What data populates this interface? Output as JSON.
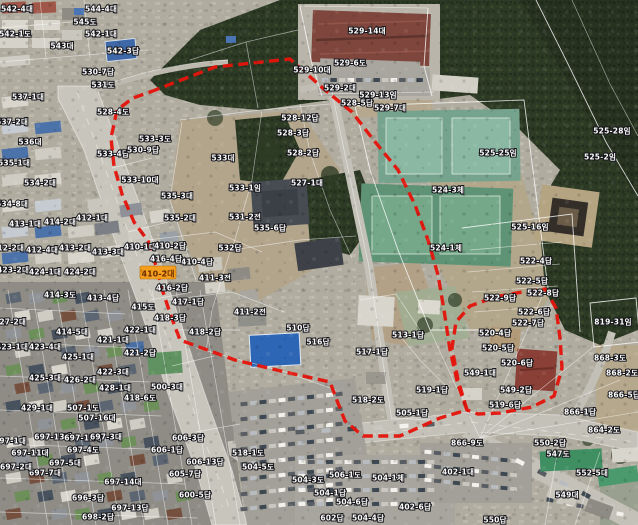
{
  "map": {
    "colors": {
      "selection_boundary": "#e4150c",
      "selected_highlight": "#f59f1e",
      "parcel_label": "#ffffff",
      "cadastral_line": "#ffffff"
    },
    "selected_parcel": {
      "text": "410-2대",
      "x": 158,
      "y": 273
    },
    "selection_boundary": {
      "main": [
        [
          150,
          92
        ],
        [
          215,
          67
        ],
        [
          290,
          59
        ],
        [
          325,
          90
        ],
        [
          352,
          112
        ],
        [
          372,
          138
        ],
        [
          398,
          170
        ],
        [
          415,
          205
        ],
        [
          428,
          240
        ],
        [
          438,
          275
        ],
        [
          444,
          310
        ],
        [
          450,
          350
        ],
        [
          458,
          385
        ],
        [
          467,
          410
        ],
        [
          440,
          418
        ],
        [
          400,
          436
        ],
        [
          363,
          436
        ],
        [
          345,
          421
        ],
        [
          336,
          398
        ],
        [
          330,
          382
        ],
        [
          285,
          372
        ],
        [
          235,
          360
        ],
        [
          180,
          340
        ],
        [
          171,
          316
        ],
        [
          163,
          292
        ],
        [
          156,
          266
        ],
        [
          148,
          241
        ],
        [
          134,
          222
        ],
        [
          122,
          194
        ],
        [
          114,
          166
        ],
        [
          111,
          138
        ],
        [
          117,
          110
        ],
        [
          133,
          98
        ]
      ],
      "east_loop": [
        [
          467,
          410
        ],
        [
          458,
          380
        ],
        [
          452,
          348
        ],
        [
          456,
          322
        ],
        [
          470,
          306
        ],
        [
          495,
          297
        ],
        [
          522,
          292
        ],
        [
          545,
          289
        ],
        [
          556,
          308
        ],
        [
          560,
          338
        ],
        [
          562,
          368
        ],
        [
          554,
          396
        ],
        [
          532,
          407
        ],
        [
          500,
          413
        ],
        [
          478,
          414
        ]
      ]
    },
    "parcel_labels": [
      {
        "t": "542-4대",
        "x": 17,
        "y": 9
      },
      {
        "t": "544-4대",
        "x": 101,
        "y": 9
      },
      {
        "t": "545도",
        "x": 85,
        "y": 22
      },
      {
        "t": "542-1도",
        "x": 15,
        "y": 34
      },
      {
        "t": "542-1대",
        "x": 101,
        "y": 34
      },
      {
        "t": "543대",
        "x": 62,
        "y": 46
      },
      {
        "t": "542-3답",
        "x": 123,
        "y": 51
      },
      {
        "t": "530-7답",
        "x": 98,
        "y": 72
      },
      {
        "t": "531도",
        "x": 103,
        "y": 85
      },
      {
        "t": "528-4도",
        "x": 113,
        "y": 112
      },
      {
        "t": "533-4답",
        "x": 113,
        "y": 154
      },
      {
        "t": "537-1대",
        "x": 28,
        "y": 97
      },
      {
        "t": "537-2대",
        "x": 12,
        "y": 122
      },
      {
        "t": "536대",
        "x": 30,
        "y": 142
      },
      {
        "t": "535-1대",
        "x": 14,
        "y": 163
      },
      {
        "t": "534-2대",
        "x": 40,
        "y": 183
      },
      {
        "t": "534-8대",
        "x": 12,
        "y": 204
      },
      {
        "t": "413-1대",
        "x": 25,
        "y": 224
      },
      {
        "t": "414-2대",
        "x": 60,
        "y": 222
      },
      {
        "t": "412-1대",
        "x": 92,
        "y": 218
      },
      {
        "t": "412-2대",
        "x": 8,
        "y": 248
      },
      {
        "t": "412-4대",
        "x": 42,
        "y": 250
      },
      {
        "t": "413-2대",
        "x": 75,
        "y": 248
      },
      {
        "t": "413-3대",
        "x": 108,
        "y": 252
      },
      {
        "t": "410-1대",
        "x": 140,
        "y": 247
      },
      {
        "t": "423-2대",
        "x": 13,
        "y": 270
      },
      {
        "t": "424-1대",
        "x": 45,
        "y": 272
      },
      {
        "t": "424-2대",
        "x": 80,
        "y": 272
      },
      {
        "t": "533-3도",
        "x": 155,
        "y": 139
      },
      {
        "t": "530-9답",
        "x": 143,
        "y": 150
      },
      {
        "t": "533-10대",
        "x": 140,
        "y": 180
      },
      {
        "t": "533대",
        "x": 223,
        "y": 158
      },
      {
        "t": "533-1임",
        "x": 245,
        "y": 188
      },
      {
        "t": "535-3대",
        "x": 177,
        "y": 196
      },
      {
        "t": "535-2대",
        "x": 180,
        "y": 218
      },
      {
        "t": "531-2전",
        "x": 245,
        "y": 217
      },
      {
        "t": "535-6답",
        "x": 270,
        "y": 228
      },
      {
        "t": "528-2답",
        "x": 303,
        "y": 153
      },
      {
        "t": "527-1대",
        "x": 307,
        "y": 183
      },
      {
        "t": "532답",
        "x": 230,
        "y": 248
      },
      {
        "t": "510답",
        "x": 298,
        "y": 328
      },
      {
        "t": "516답",
        "x": 318,
        "y": 342
      },
      {
        "t": "517-1답",
        "x": 372,
        "y": 352
      },
      {
        "t": "513-1답",
        "x": 408,
        "y": 335
      },
      {
        "t": "529-14대",
        "x": 367,
        "y": 31
      },
      {
        "t": "529-6도",
        "x": 350,
        "y": 63
      },
      {
        "t": "529-10대",
        "x": 312,
        "y": 70
      },
      {
        "t": "529-2대",
        "x": 340,
        "y": 88
      },
      {
        "t": "528-5답",
        "x": 357,
        "y": 103
      },
      {
        "t": "528-12답",
        "x": 300,
        "y": 118
      },
      {
        "t": "528-3답",
        "x": 293,
        "y": 133
      },
      {
        "t": "529-13임",
        "x": 378,
        "y": 95
      },
      {
        "t": "529-7대",
        "x": 390,
        "y": 108
      },
      {
        "t": "524-3체",
        "x": 448,
        "y": 190
      },
      {
        "t": "525-25임",
        "x": 498,
        "y": 153
      },
      {
        "t": "525-16임",
        "x": 530,
        "y": 227
      },
      {
        "t": "524-1체",
        "x": 446,
        "y": 248
      },
      {
        "t": "525-2임",
        "x": 600,
        "y": 157
      },
      {
        "t": "525-28임",
        "x": 612,
        "y": 131
      },
      {
        "t": "522-4답",
        "x": 536,
        "y": 261
      },
      {
        "t": "522-5답",
        "x": 532,
        "y": 281
      },
      {
        "t": "522-8답",
        "x": 543,
        "y": 293
      },
      {
        "t": "522-9답",
        "x": 500,
        "y": 298
      },
      {
        "t": "522-6답",
        "x": 534,
        "y": 312
      },
      {
        "t": "522-7답",
        "x": 528,
        "y": 323
      },
      {
        "t": "520-4답",
        "x": 495,
        "y": 333
      },
      {
        "t": "520-5답",
        "x": 498,
        "y": 348
      },
      {
        "t": "520-6답",
        "x": 517,
        "y": 363
      },
      {
        "t": "549-1대",
        "x": 480,
        "y": 373
      },
      {
        "t": "549-2답",
        "x": 516,
        "y": 390
      },
      {
        "t": "519-6답",
        "x": 505,
        "y": 405
      },
      {
        "t": "819-31임",
        "x": 613,
        "y": 322
      },
      {
        "t": "868-3도",
        "x": 610,
        "y": 358
      },
      {
        "t": "868-2도",
        "x": 622,
        "y": 373
      },
      {
        "t": "866-5답",
        "x": 624,
        "y": 395
      },
      {
        "t": "866-1답",
        "x": 580,
        "y": 412
      },
      {
        "t": "518-2도",
        "x": 368,
        "y": 400
      },
      {
        "t": "519-1답",
        "x": 432,
        "y": 390
      },
      {
        "t": "505-1답",
        "x": 412,
        "y": 413
      },
      {
        "t": "866-9도",
        "x": 467,
        "y": 443
      },
      {
        "t": "506-1도",
        "x": 345,
        "y": 475
      },
      {
        "t": "518-1도",
        "x": 248,
        "y": 453
      },
      {
        "t": "504-5도",
        "x": 258,
        "y": 467
      },
      {
        "t": "504-3도",
        "x": 308,
        "y": 480
      },
      {
        "t": "504-1체",
        "x": 388,
        "y": 478
      },
      {
        "t": "504-1답",
        "x": 330,
        "y": 493
      },
      {
        "t": "504-6답",
        "x": 352,
        "y": 502
      },
      {
        "t": "602답",
        "x": 332,
        "y": 518
      },
      {
        "t": "504-4답",
        "x": 368,
        "y": 518
      },
      {
        "t": "402-6답",
        "x": 415,
        "y": 507
      },
      {
        "t": "402-1대",
        "x": 458,
        "y": 472
      },
      {
        "t": "550-2답",
        "x": 550,
        "y": 443
      },
      {
        "t": "547도",
        "x": 558,
        "y": 454
      },
      {
        "t": "549대",
        "x": 567,
        "y": 495
      },
      {
        "t": "550답",
        "x": 495,
        "y": 520
      },
      {
        "t": "552-5대",
        "x": 592,
        "y": 473
      },
      {
        "t": "864-2도",
        "x": 604,
        "y": 430
      },
      {
        "t": "697-13대",
        "x": 53,
        "y": 437
      },
      {
        "t": "697-12대",
        "x": 83,
        "y": 438
      },
      {
        "t": "697-3대",
        "x": 106,
        "y": 437
      },
      {
        "t": "697-1대",
        "x": 10,
        "y": 441
      },
      {
        "t": "697-11대",
        "x": 30,
        "y": 453
      },
      {
        "t": "697-4도",
        "x": 83,
        "y": 450
      },
      {
        "t": "697-5대",
        "x": 65,
        "y": 463
      },
      {
        "t": "697-7대",
        "x": 45,
        "y": 473
      },
      {
        "t": "697-2대",
        "x": 16,
        "y": 467
      },
      {
        "t": "697-14대",
        "x": 123,
        "y": 482
      },
      {
        "t": "697-13답",
        "x": 130,
        "y": 508
      },
      {
        "t": "696-3답",
        "x": 88,
        "y": 498
      },
      {
        "t": "698-2답",
        "x": 98,
        "y": 517
      },
      {
        "t": "606-3답",
        "x": 188,
        "y": 438
      },
      {
        "t": "606-1답",
        "x": 167,
        "y": 450
      },
      {
        "t": "606-13답",
        "x": 205,
        "y": 462
      },
      {
        "t": "605-7답",
        "x": 185,
        "y": 474
      },
      {
        "t": "600-5답",
        "x": 195,
        "y": 495
      },
      {
        "t": "414-3도",
        "x": 60,
        "y": 295
      },
      {
        "t": "413-4답",
        "x": 103,
        "y": 298
      },
      {
        "t": "427-2대",
        "x": 10,
        "y": 322
      },
      {
        "t": "422-1대",
        "x": 140,
        "y": 330
      },
      {
        "t": "414-5대",
        "x": 72,
        "y": 332
      },
      {
        "t": "421-1대",
        "x": 113,
        "y": 340
      },
      {
        "t": "423-1대",
        "x": 12,
        "y": 347
      },
      {
        "t": "423-4대",
        "x": 45,
        "y": 347
      },
      {
        "t": "421-2답",
        "x": 140,
        "y": 353
      },
      {
        "t": "425-1대",
        "x": 78,
        "y": 357
      },
      {
        "t": "422-3대",
        "x": 113,
        "y": 372
      },
      {
        "t": "425-3대",
        "x": 45,
        "y": 378
      },
      {
        "t": "426-2대",
        "x": 80,
        "y": 380
      },
      {
        "t": "428-1대",
        "x": 115,
        "y": 388
      },
      {
        "t": "418-6도",
        "x": 140,
        "y": 398
      },
      {
        "t": "500-3대",
        "x": 167,
        "y": 387
      },
      {
        "t": "429-1대",
        "x": 37,
        "y": 408
      },
      {
        "t": "507-1도",
        "x": 83,
        "y": 408
      },
      {
        "t": "507-16대",
        "x": 97,
        "y": 418
      },
      {
        "t": "410-2답",
        "x": 170,
        "y": 246
      },
      {
        "t": "410-4답",
        "x": 197,
        "y": 262
      },
      {
        "t": "416-4답",
        "x": 166,
        "y": 259
      },
      {
        "t": "411-3전",
        "x": 215,
        "y": 278
      },
      {
        "t": "416-2답",
        "x": 172,
        "y": 288
      },
      {
        "t": "417-1답",
        "x": 188,
        "y": 302
      },
      {
        "t": "415도",
        "x": 143,
        "y": 307
      },
      {
        "t": "411-2전",
        "x": 250,
        "y": 312
      },
      {
        "t": "418-3답",
        "x": 170,
        "y": 318
      },
      {
        "t": "418-2답",
        "x": 205,
        "y": 332
      }
    ]
  }
}
